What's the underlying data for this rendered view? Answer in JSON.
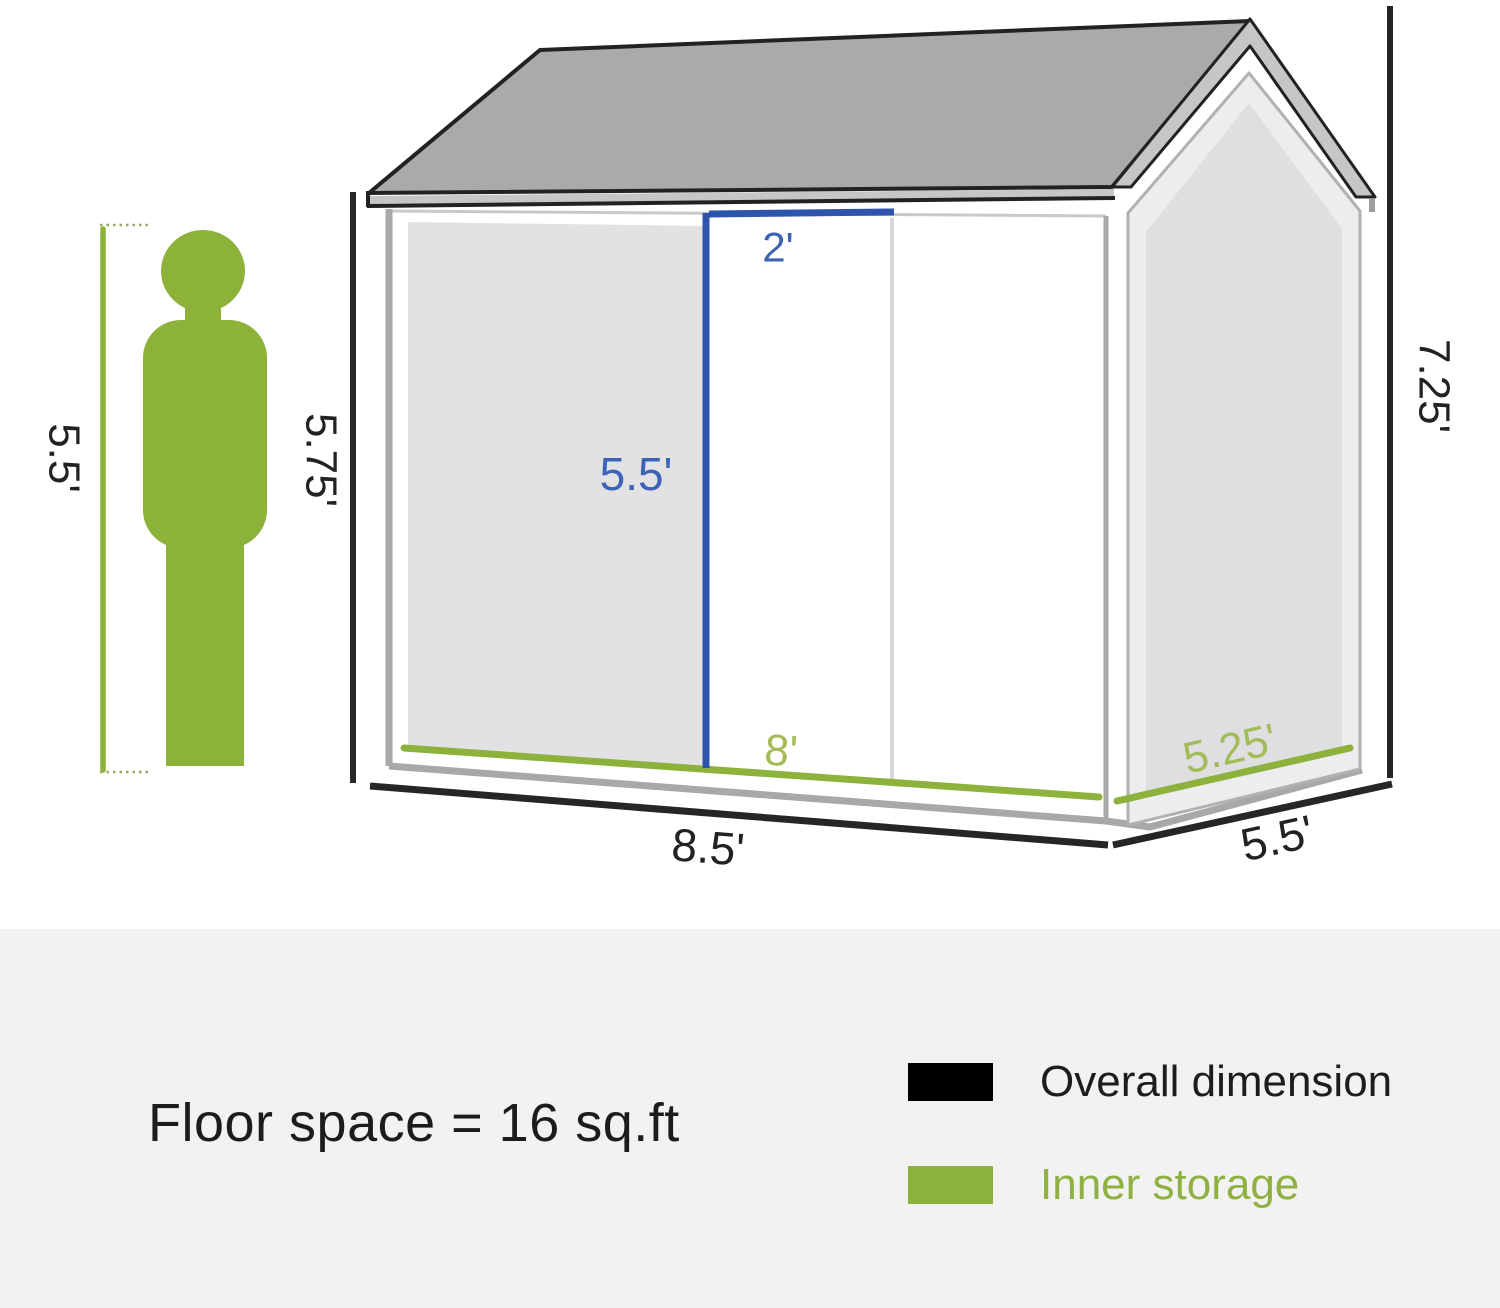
{
  "shed_diagram": {
    "person": {
      "height_label": "5.5'"
    },
    "front": {
      "wall_height_label": "5.75'",
      "door_width_label": "2'",
      "door_height_label": "5.5'",
      "inner_width_label": "8'",
      "overall_width_label": "8.5'"
    },
    "side": {
      "inner_depth_label": "5.25'",
      "overall_depth_label": "5.5'",
      "overall_height_label": "7.25'"
    }
  },
  "footer": {
    "floor_space_label": "Floor space = 16 sq.ft",
    "legend": [
      {
        "label": "Overall dimension",
        "color": "#000000"
      },
      {
        "label": "Inner storage",
        "color": "#8cb23c"
      }
    ]
  },
  "colors": {
    "overall_dimension_black": "#262626",
    "inner_storage_green": "#8cb23c",
    "green_label": "#a4bc58",
    "door_dimension_blue": "#2d55ad",
    "blue_label": "#3c63b7",
    "roof_gray": "#aaaaaa",
    "wall_frame_gray": "#a8a8a8",
    "door_panel_gray": "#e2e2e4",
    "footer_background": "#f2f2f2"
  }
}
